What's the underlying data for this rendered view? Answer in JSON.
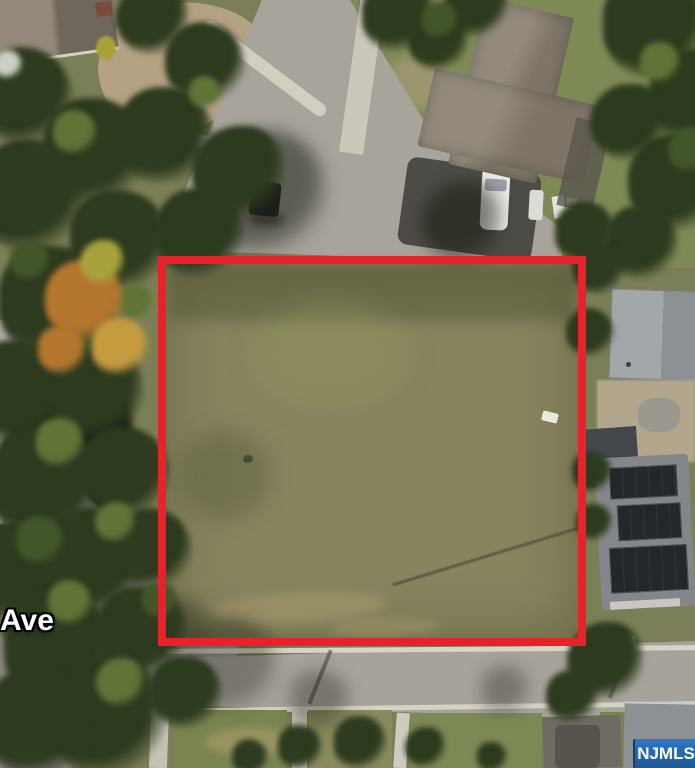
{
  "scene": {
    "type": "aerial-satellite-photo",
    "description": "Aerial view of a vacant grass lot outlined in red, surrounded by suburban houses, trees and streets",
    "street_label": "Ave",
    "watermark": "NJMLS",
    "boundary": {
      "shape": "rectangle",
      "color": "#e8222a",
      "x": 158,
      "y": 256,
      "width": 428,
      "height": 390
    },
    "colors": {
      "boundary_red": "#e8222a",
      "watermark_blue_top": "#3077c2",
      "watermark_blue_bottom": "#1b5a94",
      "lot_grass": "#87845e",
      "lawn_green": "#7e8a56",
      "road_gray": "#a8a49c",
      "sidewalk": "#cdc9bd",
      "dirt_tan": "#b5a183",
      "tree_dark": "#2c3a1e",
      "tree_light": "#5f7436",
      "autumn_orange": "#b5762e",
      "roof_warm_gray": "#8b8175",
      "roof_light_gray": "#9aa0a3",
      "solar_panel": "#23272b",
      "asphalt_dark": "#4c4b45",
      "car_white": "#eceae6"
    },
    "features": [
      "vacant-lot",
      "property-boundary",
      "street-top",
      "street-bottom",
      "cul-de-sac",
      "house-top-left",
      "house-top-right",
      "house-right",
      "solar-panel-house",
      "house-bottom-right",
      "white-car",
      "driveway",
      "trees",
      "street-label",
      "mls-watermark"
    ]
  }
}
